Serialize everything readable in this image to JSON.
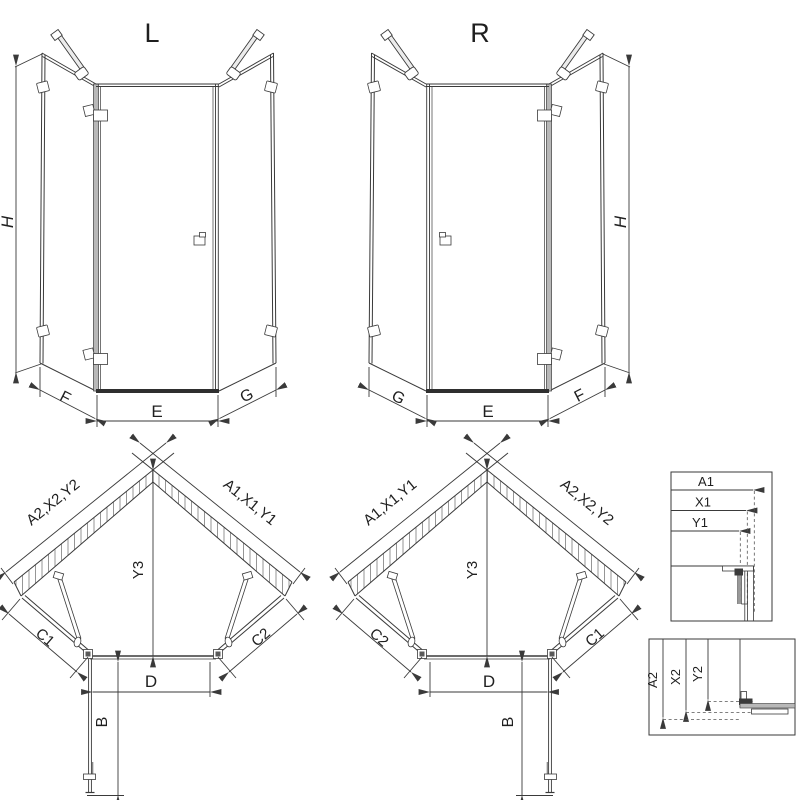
{
  "colors": {
    "line": "#3a3a3a",
    "frame_fill": "#b8b8b8",
    "sill_fill": "#2f2f2f",
    "hatch": "#8a8a8a",
    "background": "#ffffff"
  },
  "views": {
    "front_left": {
      "title": "L",
      "height": "H",
      "side_left": "F",
      "front": "E",
      "side_right": "G"
    },
    "front_right": {
      "title": "R",
      "height": "H",
      "side_left": "G",
      "front": "E",
      "side_right": "F"
    },
    "plan_left": {
      "wall_left": "A2,X2,Y2",
      "wall_right": "A1,X1,Y1",
      "depth": "Y3",
      "side_left": "C1",
      "side_right": "C2",
      "opening": "D",
      "door": "B"
    },
    "plan_right": {
      "wall_left": "A1,X1,Y1",
      "wall_right": "A2,X2,Y2",
      "depth": "Y3",
      "side_left": "C2",
      "side_right": "C1",
      "opening": "D",
      "door": "B"
    },
    "detail_top": {
      "rows": [
        "A1",
        "X1",
        "Y1"
      ]
    },
    "detail_bottom": {
      "rows": [
        "A2",
        "X2",
        "Y2"
      ]
    }
  }
}
